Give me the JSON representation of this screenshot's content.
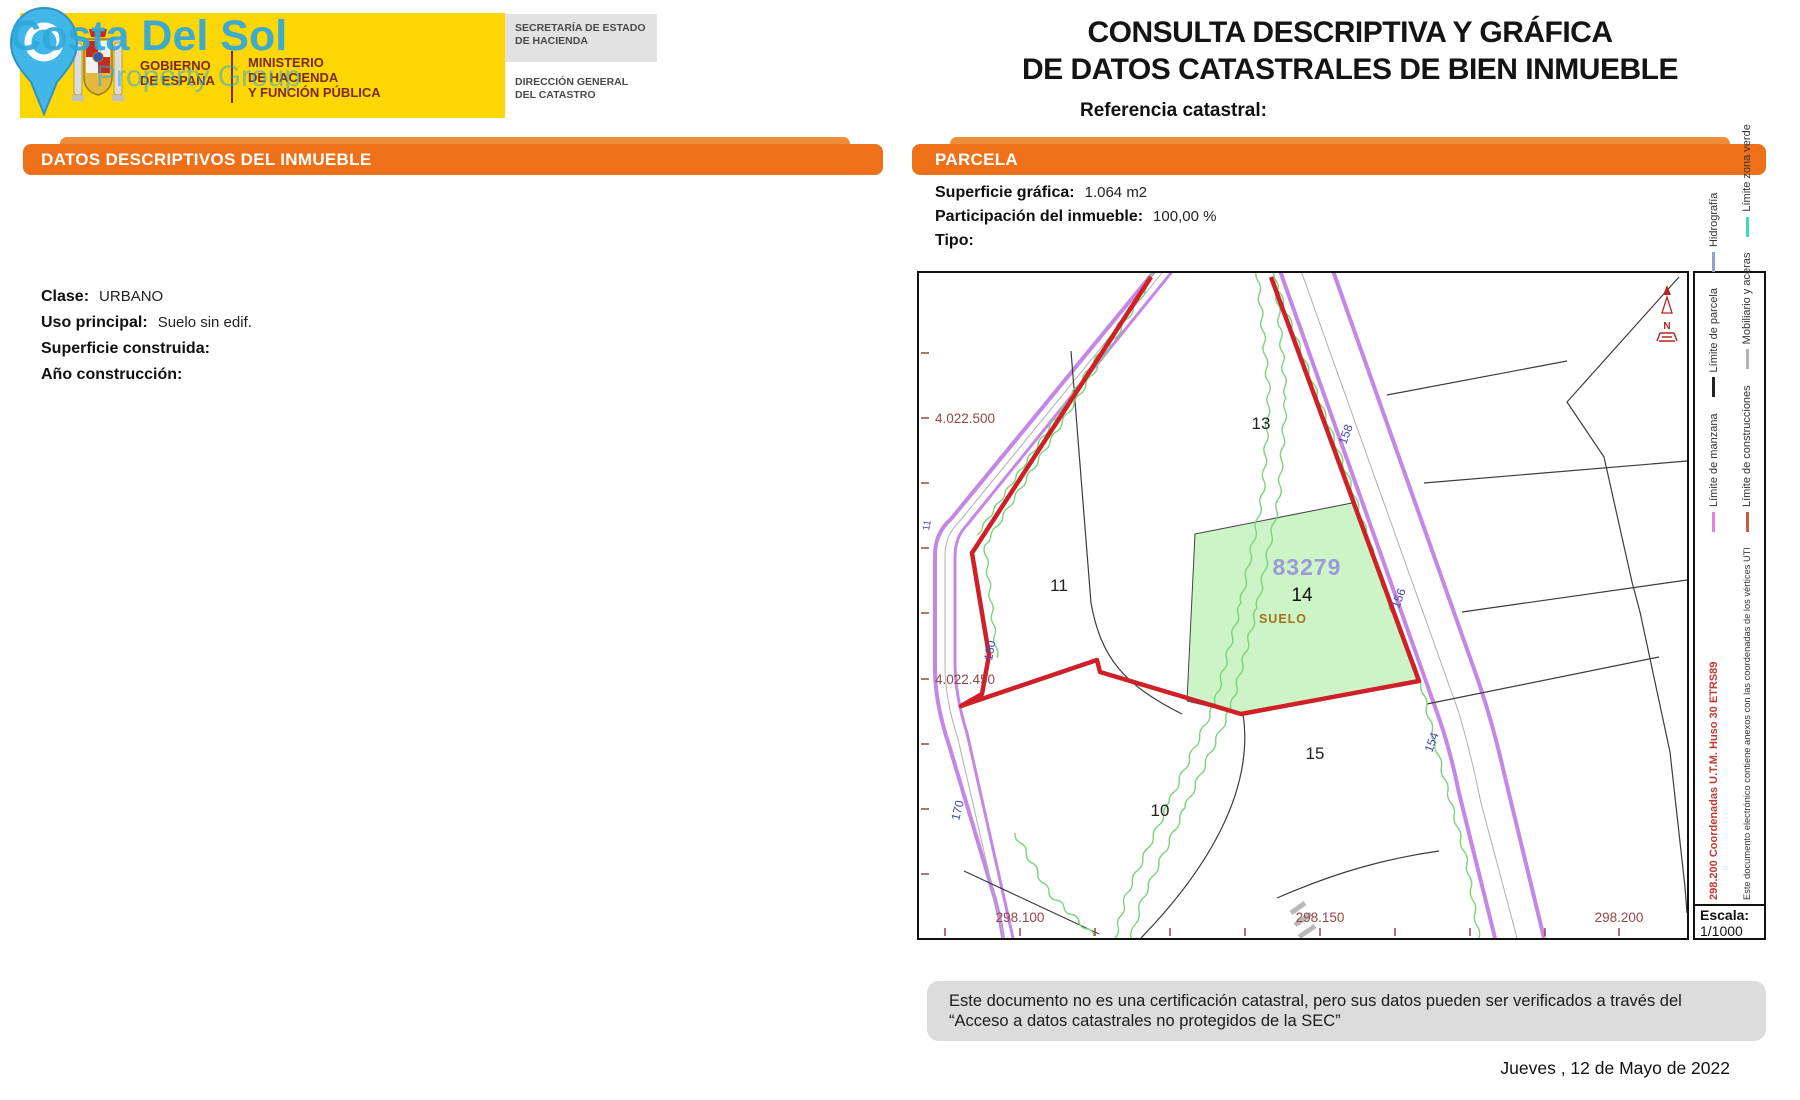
{
  "watermark": {
    "line1": "Costa Del Sol",
    "line2": "Property Group"
  },
  "gov_banner": {
    "gobierno_l1": "GOBIERNO",
    "gobierno_l2": "DE ESPAÑA",
    "ministerio_l1": "MINISTERIO",
    "ministerio_l2": "DE HACIENDA",
    "ministerio_l3": "Y FUNCIÓN PÚBLICA"
  },
  "secretaria": {
    "l1": "SECRETARÍA DE ESTADO",
    "l2": "DE HACIENDA",
    "l3": "DIRECCIÓN GENERAL",
    "l4": "DEL CATASTRO"
  },
  "title": {
    "line1": "CONSULTA DESCRIPTIVA Y GRÁFICA",
    "line2": "DE DATOS CATASTRALES DE BIEN INMUEBLE",
    "ref_label": "Referencia catastral:"
  },
  "left_panel": {
    "header_prefix": "DATOS DESCRIPTIVOS DEL ",
    "header_emphasis": "INMUEBLE",
    "fields": [
      {
        "label": "Clase:",
        "value": "URBANO"
      },
      {
        "label": "Uso principal:",
        "value": "Suelo sin edif."
      },
      {
        "label": "Superficie construida:",
        "value": ""
      },
      {
        "label": "Año construcción:",
        "value": ""
      }
    ]
  },
  "parcel_panel": {
    "header": "PARCELA",
    "fields": [
      {
        "label": "Superficie gráfica:",
        "value": "1.064 m2"
      },
      {
        "label": "Participación del inmueble:",
        "value": "100,00 %"
      },
      {
        "label": "Tipo:",
        "value": ""
      }
    ]
  },
  "map": {
    "labels": {
      "p10": "10",
      "p11": "11",
      "p13": "13",
      "p15": "15"
    },
    "highlight": {
      "ref": "83279",
      "number": "14",
      "use": "SUELO"
    },
    "axis": {
      "left_top": "4.022.500",
      "left_bottom": "4.022.450",
      "bottom_1": "298.100",
      "bottom_2": "298.150",
      "bottom_3": "298.200"
    },
    "contours": {
      "c180": "180",
      "c170": "170",
      "c158": "158",
      "c156": "156",
      "c154": "154",
      "c11": "11"
    },
    "north": "N"
  },
  "legend": {
    "row1": {
      "note": "298.200 Coordenadas U.T.M. Huso 30 ETRS89",
      "items": [
        {
          "label": "Límite de manzana",
          "color": "#ef7cdf"
        },
        {
          "label": "Límite de parcela",
          "color": "#222222"
        },
        {
          "label": "Hidrografía",
          "color": "#8fa3c8"
        }
      ]
    },
    "row2": {
      "note": "Este documento electrónico contiene anexos con las coordenadas de los vértices UTM de la parcela y los datos de la certificación.",
      "items": [
        {
          "label": "Límite de construcciones",
          "color": "#c85a4a"
        },
        {
          "label": "Mobiliario y aceras",
          "color": "#b4b4b4"
        },
        {
          "label": "Límite zona verde",
          "color": "#3cd9c0"
        }
      ]
    },
    "escala_label": "Escala:",
    "escala_value": "1/1000"
  },
  "footer": {
    "disclaimer": "Este documento no es una certificación catastral, pero sus datos pueden ser verificados a través del “Acceso a datos catastrales no protegidos de la SEC”",
    "date": "Jueves , 12 de Mayo de 2022"
  },
  "colors": {
    "accent_orange": "#ee7019",
    "banner_yellow": "#fcd703",
    "boundary_red": "#cf2027",
    "road_purple": "#c487e6",
    "parcel_green_fill": "#ccf4c6",
    "green_line": "#7bd47b",
    "coord_red": "#964646",
    "contour_blue": "#4847b6",
    "highlight_ref": "#9a9ad8",
    "watermark_blue": "#2fa8dc"
  }
}
